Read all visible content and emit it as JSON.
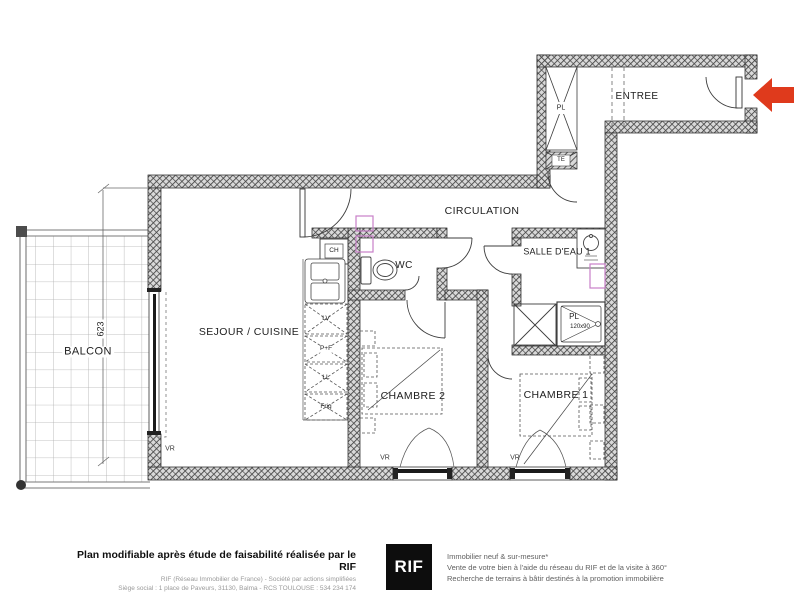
{
  "plan": {
    "room_labels": {
      "balcon": "BALCON",
      "sejour": "SEJOUR / CUISINE",
      "chambre2": "CHAMBRE 2",
      "chambre1": "CHAMBRE 1",
      "wc": "WC",
      "salle_deau": "SALLE D'EAU 1",
      "circulation": "CIRCULATION",
      "entree": "ENTREE"
    },
    "fixture_labels": {
      "ch": "CH",
      "lv": "LV",
      "pf": "P+F",
      "ll": "LL",
      "frig": "Frig",
      "pl_entree": "PL",
      "te": "TE",
      "pl_douche": "PL",
      "douche_size": "120x90",
      "vr": "VR"
    },
    "dimension_balcon": "623"
  },
  "icons": {
    "entrance_arrow": "red-left-arrow"
  },
  "colors": {
    "arrow": "#df3a1c",
    "magenta_symbol": "#c77fc7",
    "wall_hatch": "#474747"
  },
  "footer": {
    "left_bold": "Plan modifiable après étude de faisabilité réalisée par le RIF",
    "left_line2": "RIF (Réseau Immobilier de France) - Société par actions simplifiées",
    "left_line3": "Siège social : 1 place de Paveurs, 31130, Balma - RCS TOULOUSE : 534 234 174",
    "logo": "RIF",
    "right_line1": "Immobilier neuf & sur-mesure*",
    "right_line2": "Vente de votre bien à l'aide du réseau du RIF et de la visite à 360°",
    "right_line3": "Recherche de terrains à bâtir destinés à la promotion immobilière"
  }
}
